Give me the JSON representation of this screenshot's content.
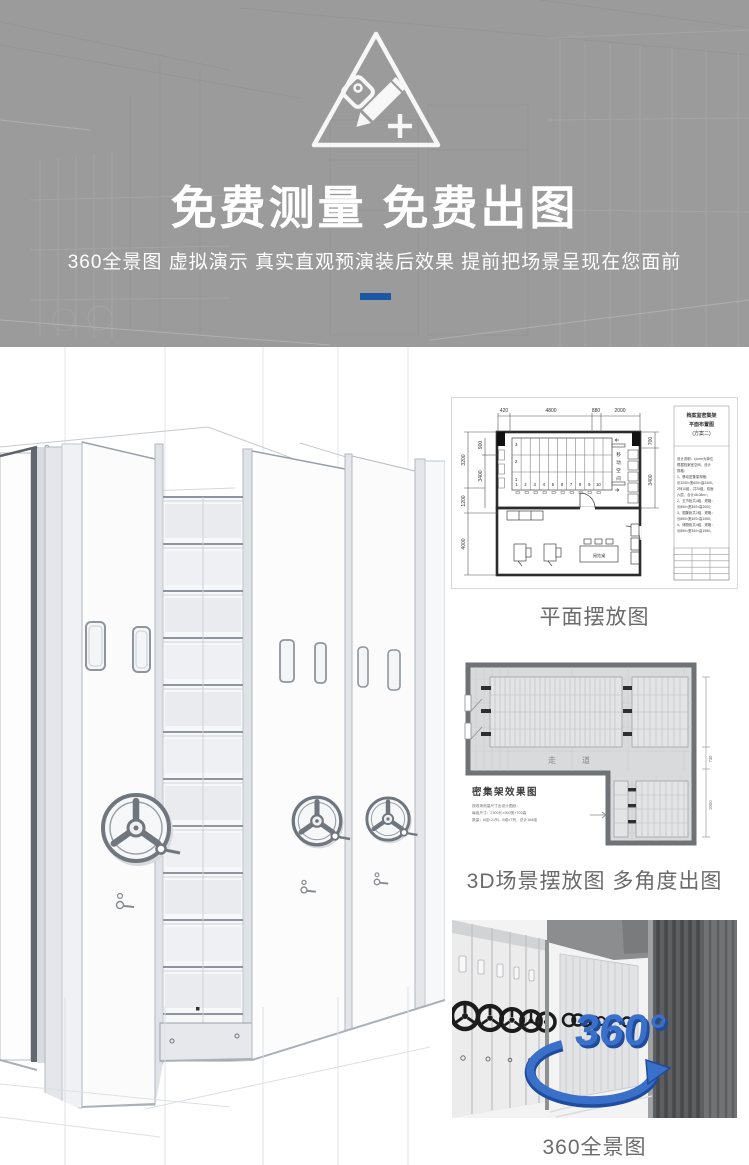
{
  "banner": {
    "title": "免费测量 免费出图",
    "subtitle": "360全景图 虚拟演示 真实直观预演装后效果 提前把场景呈现在您面前",
    "colors": {
      "background": "#9b9b9b",
      "accent_dash": "#1b57a5",
      "text": "#ffffff"
    }
  },
  "gallery": {
    "floor_plan": {
      "caption": "平面摆放图",
      "title_block": {
        "line1": "档案室密集架",
        "line2": "平面布置图",
        "line3": "(方案二)"
      },
      "dims_top": [
        "420",
        "4800",
        "880",
        "2000"
      ],
      "dims_left_outer": [
        "3200",
        "1200",
        "4000"
      ],
      "dims_left_inner": [
        "900",
        "3400"
      ],
      "dims_right": [
        "700",
        "3400"
      ],
      "row_labels": [
        "3",
        "2",
        "1"
      ],
      "column_numbers": [
        "1",
        "2",
        "3",
        "4",
        "5",
        "6",
        "7",
        "8",
        "9",
        "10"
      ],
      "moving_space_chars": [
        "移",
        "动",
        "空",
        "间"
      ],
      "reading_table_label": "阅览桌",
      "notes": [
        "设计说明：以mm为单位",
        "根据档案室空间，设计",
        "规格：",
        "1、移动密集架规格：",
        "长3200×宽600×高2400；",
        "2列10组，共20组，双面",
        "六层，合计46.08m²；",
        "2、五节柜共4组，规格：",
        "长850×宽300×高2000；",
        "3、图集柜共2组，规格：",
        "长850×宽400×高1950；",
        "4、储物柜共4组，规格：",
        "长850×宽300×高1950。"
      ]
    },
    "scene_3d": {
      "caption": "3D场景摆放图 多角度出图",
      "drawing_title": "密集架效果图",
      "aisle_label": "走道",
      "dims_right": [
        "730",
        "2000"
      ],
      "spec_lines": [
        "按现场测量尺寸出设计图纸：",
        "每组尺寸：2300长×900宽×700高",
        "数量：6组×21列，6组×7列，总计168组"
      ]
    },
    "panorama": {
      "caption": "360全景图",
      "logo_text": "360°"
    }
  }
}
